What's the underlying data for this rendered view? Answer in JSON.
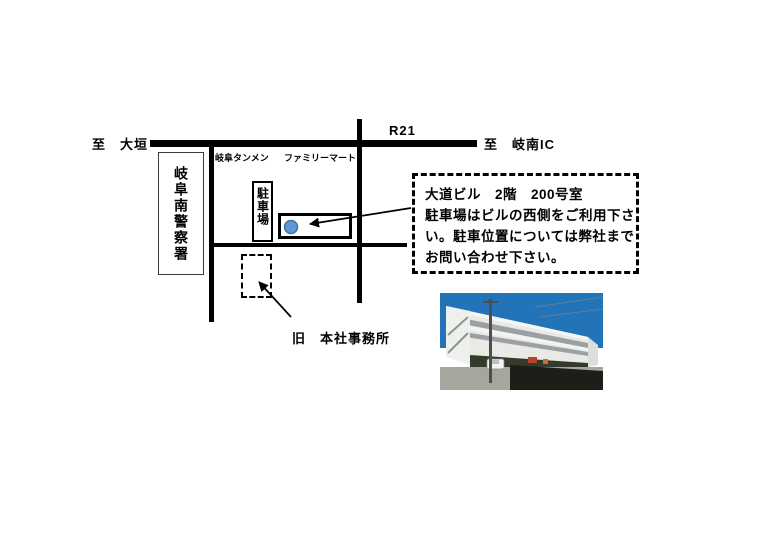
{
  "map": {
    "labels": {
      "to_ogaki": "至　大垣",
      "route": "R21",
      "to_ginan": "至　岐南IC",
      "gifu_tanmen": "岐阜タンメン",
      "familymart": "ファミリーマート",
      "police_station": "岐阜南警察署",
      "parking": "駐車場",
      "old_office": "旧　本社事務所"
    },
    "marker": {
      "fill_color": "#5b9bd5",
      "border_color": "#41719c"
    }
  },
  "info_box": {
    "lines": [
      "大道ビル　2階　200号室",
      "駐車場はビルの西側をご利用下さ",
      "い。駐車位置については弊社まで",
      "お問い合わせ下さい。"
    ]
  }
}
